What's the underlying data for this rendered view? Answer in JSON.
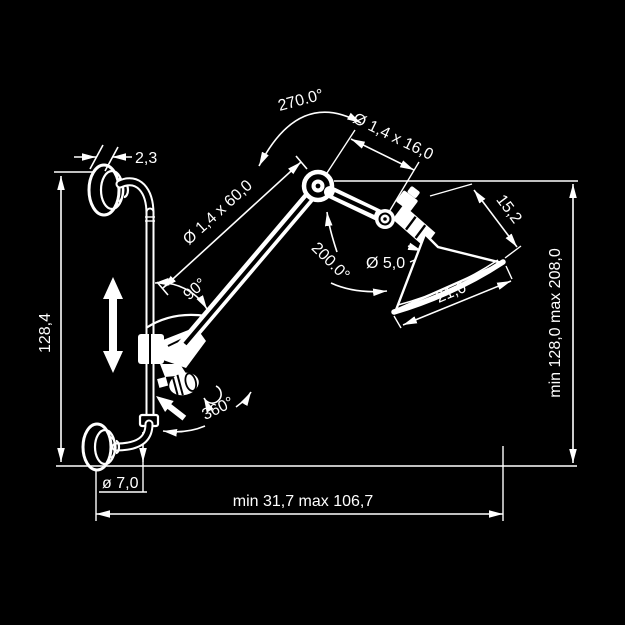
{
  "diagram": {
    "type": "technical-drawing",
    "subject": "wall-mounted articulated swing-arm lamp, dimensional drawing",
    "colors": {
      "background": "#000000",
      "line": "#ffffff"
    },
    "labels": {
      "swivel_top": "270.0°",
      "upper_arm": "Ø 1,4 x 16,0",
      "plate_thickness": "2,3",
      "lower_arm": "Ø 1,4 x 60,0",
      "arm_angle": "90°",
      "head_swivel": "200.0°",
      "stem_diameter": "Ø 5,0",
      "shade_depth": "15,2",
      "shade_width": "21,0",
      "rail_length": "128,4",
      "height_range": "min 128,0  max 208,0",
      "tube_diameter": "ø 7,0",
      "reach_range": "min 31,7   max 106,7",
      "base_rotation": "360°"
    }
  }
}
